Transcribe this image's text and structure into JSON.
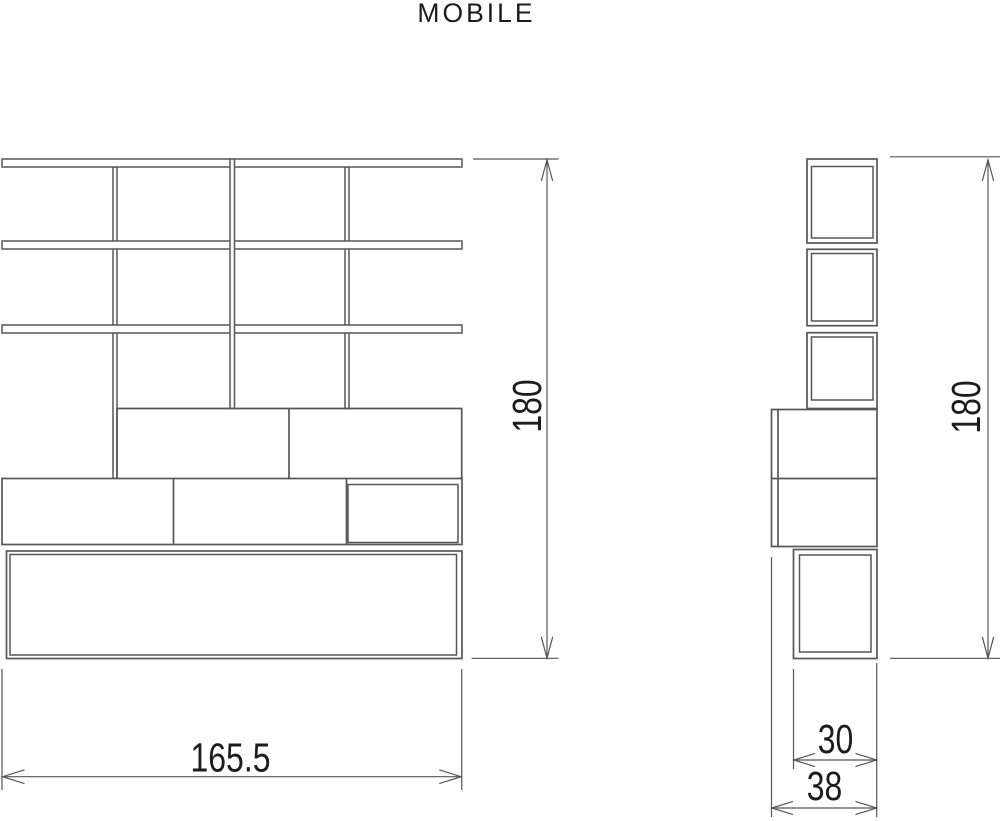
{
  "title": "MOBILE",
  "dimensions": {
    "front_width": "165.5",
    "front_height": "180",
    "side_height": "180",
    "base_depth": "30",
    "overall_depth": "38"
  },
  "colors": {
    "line": "#565656",
    "dim": "#565656",
    "text": "#1c1c1c",
    "background": "#ffffff"
  }
}
